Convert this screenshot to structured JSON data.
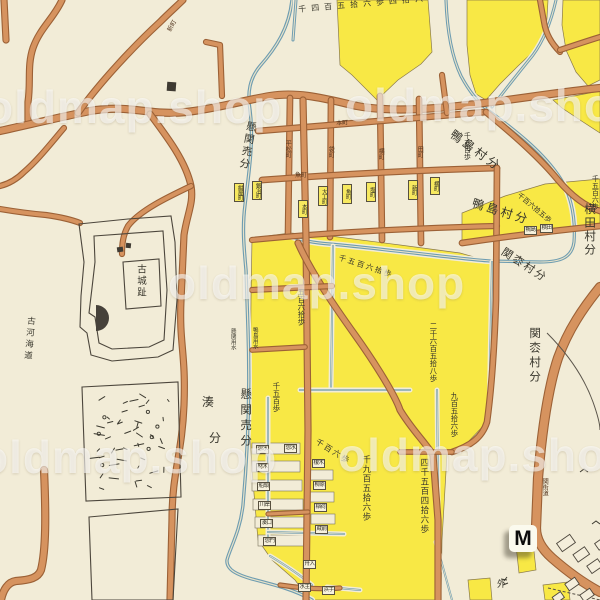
{
  "map": {
    "watermark": "oldmap.shop",
    "marker": "M",
    "villages": {
      "kamojima": "鴨島村分",
      "yokota": "横田村分",
      "sekimatsu": "関枩村分",
      "kakeseki": "懸関売分",
      "minato_1": "湊",
      "minato_2": "分",
      "kogakaido": "古河海道",
      "kojoshi": "古城趾"
    },
    "waterways": {
      "kakeseki_yosui": "懸関用水",
      "kamojima_yosui": "鴨島用水"
    },
    "area_labels": [
      "千四百五拾六歩四拾六",
      "千五百歩",
      "千百六拾五歩",
      "千五百六歩",
      "千五百六拾歩",
      "五百六拾歩",
      "千五百歩",
      "千百六歩",
      "千九百五拾六歩",
      "四千五百四拾六歩",
      "九百五拾六歩",
      "二千六百五拾八歩",
      "外"
    ],
    "street_names": [
      "平松町",
      "袋町",
      "横町",
      "田町",
      "本町",
      "魚町",
      "新町",
      "関街道"
    ],
    "block_tags": [
      "紺屋町",
      "鍛冶町",
      "大工町",
      "魚町",
      "塩町",
      "本町",
      "新町",
      "横町",
      "鴨島",
      "横田",
      "惣水",
      "惣水",
      "材木",
      "船頭",
      "川岸",
      "湊口",
      "惣門",
      "榎木",
      "柳原",
      "稲荷",
      "蔵前",
      "舟入",
      "水主",
      "浜手"
    ],
    "colors": {
      "background": "#f2ecd7",
      "field_yellow": "#f8e845",
      "road_fill": "#d6935f",
      "road_edge": "#9c6136",
      "stream_blue": "#6d9cb1",
      "outline_black": "#4c463c",
      "ink": "#3a382e"
    }
  }
}
